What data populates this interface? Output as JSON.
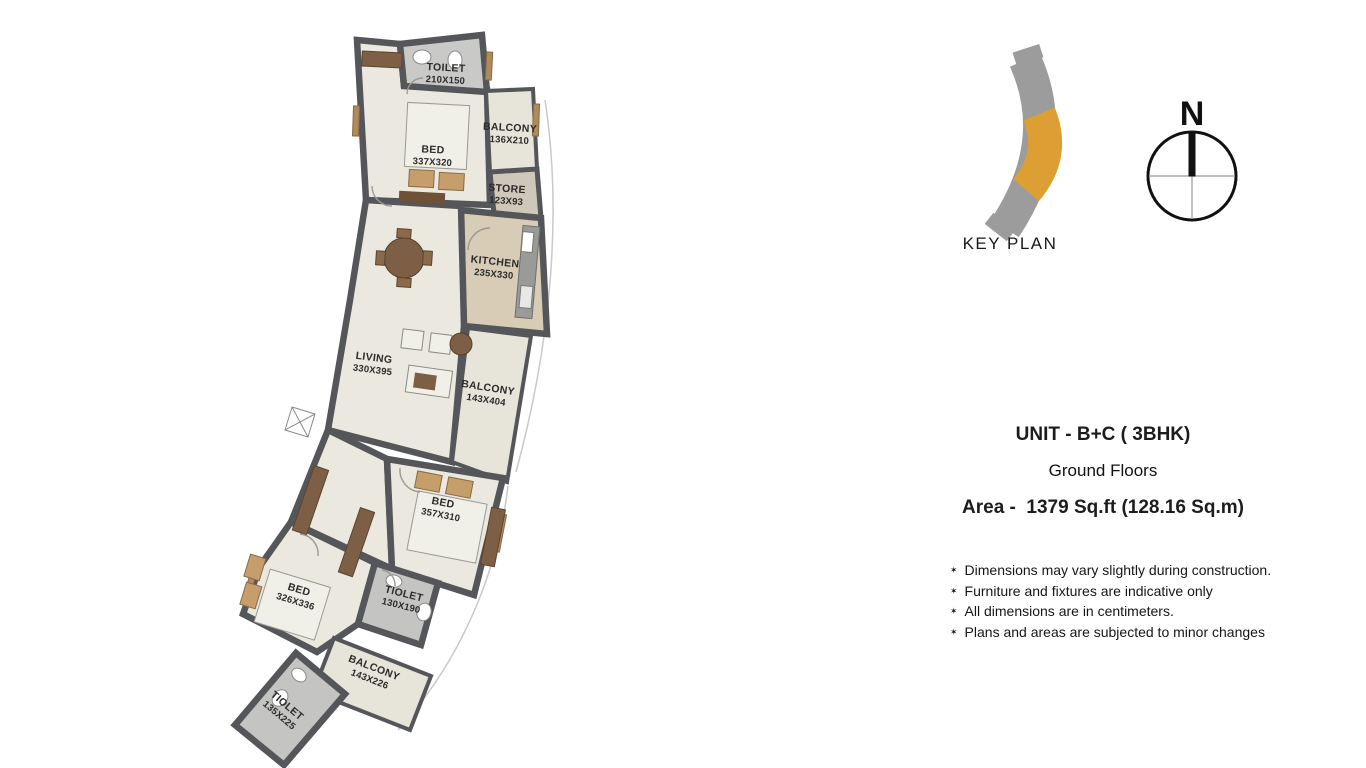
{
  "plan": {
    "rooms": [
      {
        "name": "TOILET",
        "dims": "210X150"
      },
      {
        "name": "BED",
        "dims": "337X320"
      },
      {
        "name": "BALCONY",
        "dims": "136X210"
      },
      {
        "name": "STORE",
        "dims": "123X93"
      },
      {
        "name": "KITCHEN",
        "dims": "235X330"
      },
      {
        "name": "LIVING",
        "dims": "330X395"
      },
      {
        "name": "BALCONY",
        "dims": "143X404"
      },
      {
        "name": "BED",
        "dims": "357X310"
      },
      {
        "name": "BED",
        "dims": "326X336"
      },
      {
        "name": "TIOLET",
        "dims": "130X190"
      },
      {
        "name": "BALCONY",
        "dims": "143X226"
      },
      {
        "name": "TIOLET",
        "dims": "135X225"
      }
    ],
    "wall_color": "#55565a",
    "floor_color": "#eae8df",
    "kitchen_floor_color": "#d9ccb6",
    "toilet_floor_color": "#c9c9c7"
  },
  "key_plan": {
    "label": "KEY PLAN",
    "building_color": "#9c9c9c",
    "highlight_color": "#dd9e33"
  },
  "compass": {
    "label": "N"
  },
  "unit_info": {
    "title": "UNIT - B+C ( 3BHK)",
    "floor": "Ground Floors",
    "area": "Area -  1379 Sq.ft (128.16 Sq.m)"
  },
  "notes": {
    "bullet": "✶",
    "items": [
      "Dimensions may vary slightly during construction.",
      "Furniture and fixtures are indicative only",
      "All dimensions are in centimeters.",
      "Plans and areas are subjected to minor changes"
    ]
  }
}
